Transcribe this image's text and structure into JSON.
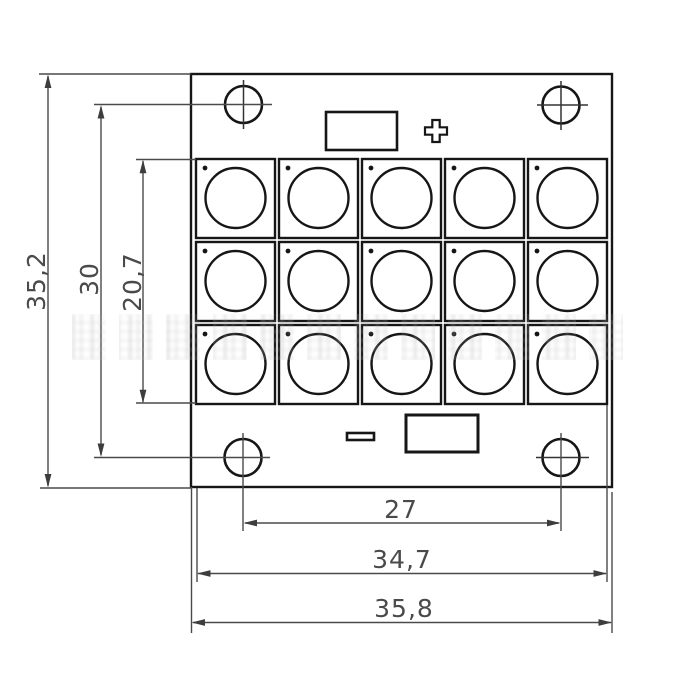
{
  "drawing": {
    "kind": "led-module-dimension-drawing",
    "dimensions": {
      "overall_height": "35,2",
      "mount_hole_spacing_vertical": "30",
      "led_array_height": "20,7",
      "mount_hole_spacing_horizontal": "27",
      "inner_width": "34,7",
      "overall_width": "35,8"
    },
    "symbols": {
      "positive": "+",
      "negative": "−"
    },
    "led_grid": {
      "rows": 3,
      "cols": 5,
      "count": 15
    },
    "mount_holes": 4,
    "colors": {
      "line": "#161616",
      "dimension": "#4a4a4a",
      "background": "#ffffff",
      "watermark": "#c9c9c9"
    }
  }
}
